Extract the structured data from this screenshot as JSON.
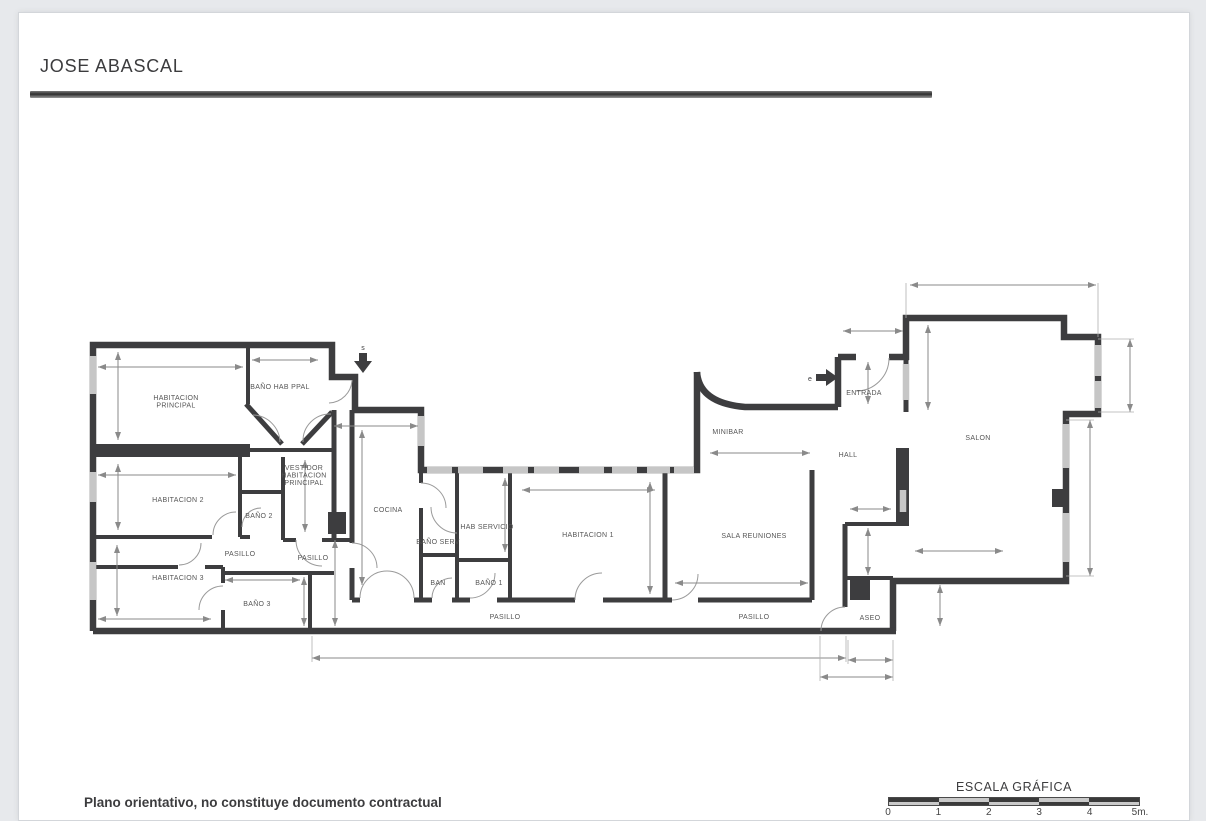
{
  "page": {
    "title": "JOSE ABASCAL",
    "footer_note": "Plano orientativo, no constituye documento contractual"
  },
  "scale": {
    "title": "ESCALA GRÁFICA",
    "ticks": [
      "0",
      "1",
      "2",
      "3",
      "4",
      "5m."
    ]
  },
  "markers": {
    "service_letter": "s",
    "entrance_letter": "e"
  },
  "rooms": [
    {
      "id": "habitacion-principal",
      "lines": [
        "HABITACION",
        "PRINCIPAL"
      ],
      "x": 176,
      "y": 400
    },
    {
      "id": "bano-hab-ppal",
      "lines": [
        "BAÑO HAB PPAL"
      ],
      "x": 280,
      "y": 389
    },
    {
      "id": "vestidor-habitacion-principal",
      "lines": [
        "VESTIDOR",
        "HABITACION",
        "PRINCIPAL"
      ],
      "x": 304,
      "y": 470
    },
    {
      "id": "habitacion-2",
      "lines": [
        "HABITACION 2"
      ],
      "x": 178,
      "y": 502
    },
    {
      "id": "bano-2",
      "lines": [
        "BAÑO 2"
      ],
      "x": 259,
      "y": 518
    },
    {
      "id": "pasillo-izq-1",
      "lines": [
        "PASILLO"
      ],
      "x": 240,
      "y": 556
    },
    {
      "id": "pasillo-izq-2",
      "lines": [
        "PASILLO"
      ],
      "x": 313,
      "y": 560
    },
    {
      "id": "habitacion-3",
      "lines": [
        "HABITACION 3"
      ],
      "x": 178,
      "y": 580
    },
    {
      "id": "bano-3",
      "lines": [
        "BAÑO 3"
      ],
      "x": 257,
      "y": 606
    },
    {
      "id": "cocina",
      "lines": [
        "COCINA"
      ],
      "x": 388,
      "y": 512
    },
    {
      "id": "bano-serv",
      "lines": [
        "BAÑO SERV"
      ],
      "x": 438,
      "y": 544
    },
    {
      "id": "hab-servicio",
      "lines": [
        "HAB SERVICIO"
      ],
      "x": 487,
      "y": 529
    },
    {
      "id": "habitacion-1",
      "lines": [
        "HABITACION 1"
      ],
      "x": 588,
      "y": 537
    },
    {
      "id": "ban",
      "lines": [
        "BAN"
      ],
      "x": 438,
      "y": 585
    },
    {
      "id": "bano-1",
      "lines": [
        "BAÑO 1"
      ],
      "x": 489,
      "y": 585
    },
    {
      "id": "pasillo-centro",
      "lines": [
        "PASILLO"
      ],
      "x": 505,
      "y": 619
    },
    {
      "id": "sala-reuniones",
      "lines": [
        "SALA REUNIONES"
      ],
      "x": 754,
      "y": 538
    },
    {
      "id": "pasillo-dcha",
      "lines": [
        "PASILLO"
      ],
      "x": 754,
      "y": 619
    },
    {
      "id": "minibar",
      "lines": [
        "MINIBAR"
      ],
      "x": 728,
      "y": 434
    },
    {
      "id": "hall",
      "lines": [
        "HALL"
      ],
      "x": 848,
      "y": 457
    },
    {
      "id": "entrada",
      "lines": [
        "ENTRADA"
      ],
      "x": 864,
      "y": 395
    },
    {
      "id": "salon",
      "lines": [
        "SALON"
      ],
      "x": 978,
      "y": 440
    },
    {
      "id": "aseo",
      "lines": [
        "ASEO"
      ],
      "x": 870,
      "y": 620
    }
  ]
}
